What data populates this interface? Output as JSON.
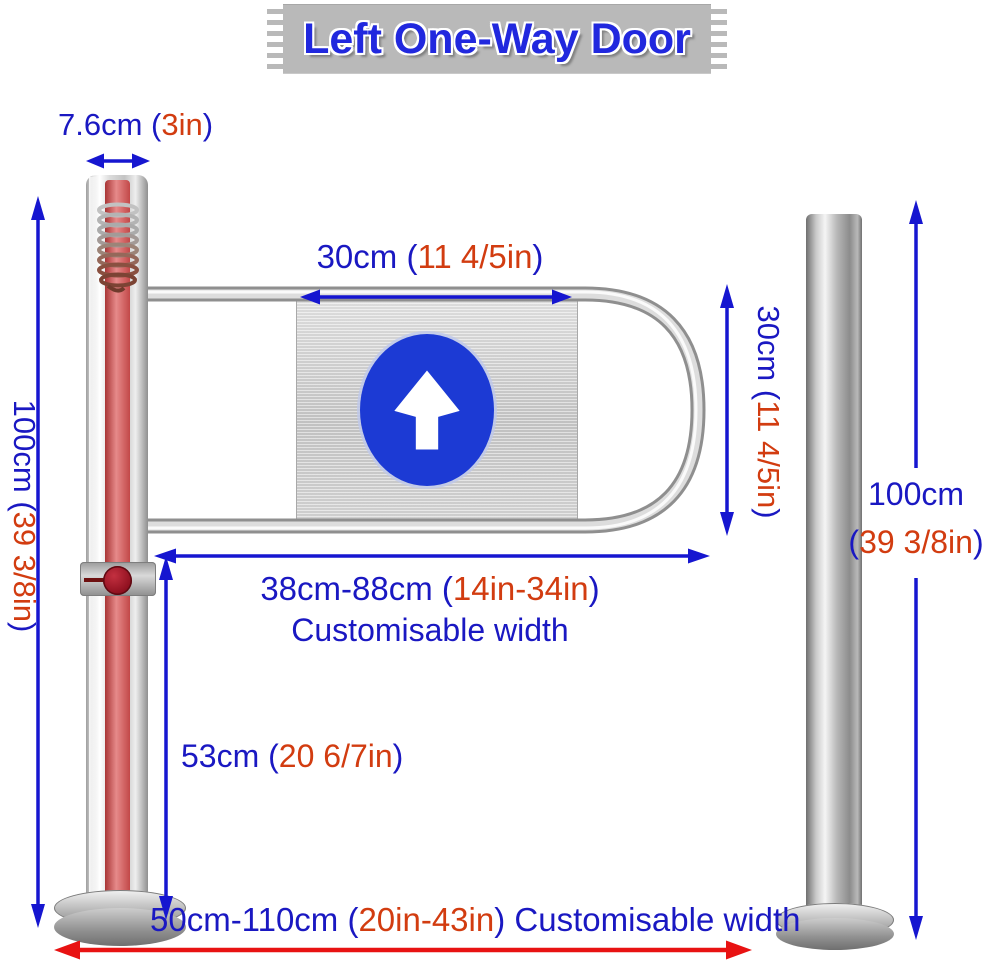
{
  "title": "Left One-Way Door",
  "labels": {
    "pole_width": {
      "pre": "7.6cm (",
      "accent": "3in",
      "post": ")"
    },
    "left_height": {
      "pre": "100cm (",
      "accent": "39 3/8in",
      "post": ")"
    },
    "sign_width": {
      "pre": "30cm (",
      "accent": "11 4/5in",
      "post": ")"
    },
    "gate_height": {
      "pre": "30cm (",
      "accent": "11 4/5in",
      "post": ")"
    },
    "gate_width": {
      "pre": "38cm-88cm (",
      "accent": "14in-34in",
      "post": ")"
    },
    "gate_width_note": "Customisable width",
    "handle_height": {
      "pre": "53cm (",
      "accent": "20 6/7in",
      "post": ")"
    },
    "right_height_value": "100cm",
    "right_height_paren": {
      "pre": "(",
      "accent": "39 3/8in",
      "post": ")"
    },
    "total_width": {
      "pre": "50cm-110cm (",
      "accent": "20in-43in",
      "post": ") Customisable width"
    }
  },
  "icons": {
    "sign_arrow": "up-arrow-icon",
    "dimension_arrows": "double-headed-arrow-icon"
  },
  "colors": {
    "dimension_blue": "#1a18c2",
    "dimension_red": "#d23c10",
    "arrow_blue": "#1616d0",
    "arrow_red": "#e81212",
    "sign_circle_blue": "#1c3ad4",
    "banner_background": "#b9b9b9",
    "banner_text_blue": "#2128de"
  }
}
